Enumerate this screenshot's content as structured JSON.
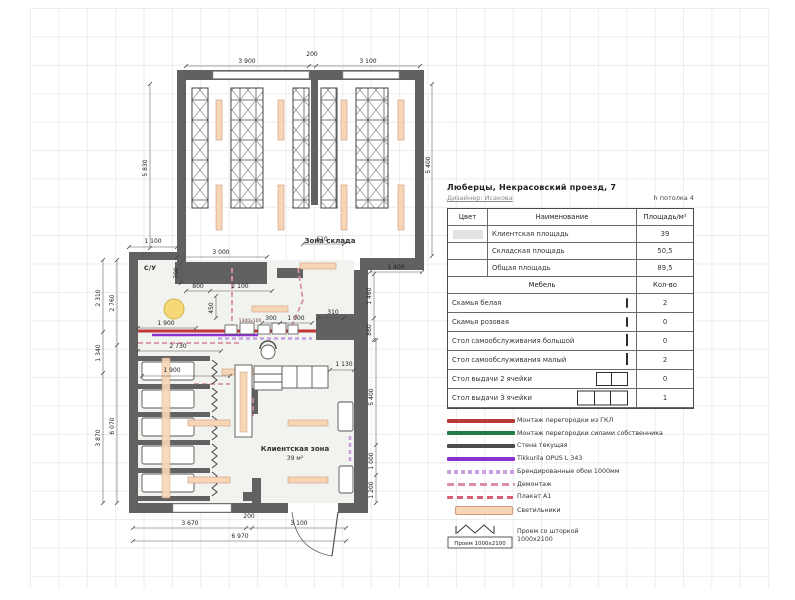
{
  "header": {
    "address": "Люберцы,  Некрасовский проезд, 7",
    "designer": "Дизайнер: Исакова",
    "ceiling": "h потолка 4"
  },
  "area_table": {
    "col_color": "Цвет",
    "col_name": "Наименование",
    "col_area": "Площадь/м²",
    "rows": [
      {
        "name": "Клиентская площадь",
        "area": "39"
      },
      {
        "name": "Складская площадь",
        "area": "50,5"
      },
      {
        "name": "Общая площадь",
        "area": "89,5"
      }
    ]
  },
  "furniture_table": {
    "col_name": "Мебель",
    "col_qty": "Кол-во",
    "rows": [
      {
        "name": "Скамья белая",
        "qty": "2"
      },
      {
        "name": "Скамья розовая",
        "qty": "0"
      },
      {
        "name": "Стол самообслуживания большой",
        "qty": "0"
      },
      {
        "name": "Стол самообслуживания малый",
        "qty": "2"
      },
      {
        "name": "Стол выдачи 2 ячейки",
        "qty": "0"
      },
      {
        "name": "Стол выдачи 3 ячейки",
        "qty": "1"
      }
    ]
  },
  "legend": {
    "gkl": "Монтаж перегородки из ГКЛ",
    "owner": "Монтаж перегородки силами собственника",
    "wall": "Стена текущая",
    "paint": "Tikkurila OPUS L 343",
    "wallpaper": "Брендированные обои 1000мм",
    "demontage": "Демонтаж",
    "poster": "Плакат А1",
    "lamps": "Светильники",
    "curtain": "Проем со шторкой 1000х2100",
    "curtain_box": "Проем 1000х2100"
  },
  "plan": {
    "labels": {
      "storage": "Зона склада",
      "client": "Клиентская зона",
      "client_area": "39 м²",
      "wc": "С/У",
      "shelf": "1300х100"
    },
    "dims": {
      "top_a": "3 900",
      "top_b": "200",
      "top_c": "3 100",
      "stor_left": "5 830",
      "stor_right": "5 400",
      "notch": "1 100",
      "w3000": "3 000",
      "d700": "700",
      "d800": "800",
      "d2100": "2 100",
      "d450": "450",
      "d610": "610",
      "d1400": "1 400",
      "d1460": "1 460",
      "d860": "860",
      "d1900a": "1 900",
      "d2730": "2 730",
      "d300": "300",
      "d1000": "1 000",
      "d310": "310",
      "d1130": "1 130",
      "d1900b": "1 900",
      "l2310": "2 310",
      "l1340": "1 340",
      "l3870": "3 870",
      "l2760": "2 760",
      "l6070": "6 070",
      "r5400": "5 400",
      "r1000": "1 000",
      "r1200": "1 200",
      "b3670": "3 670",
      "b200": "200",
      "b3100": "3 100",
      "b6970": "6 970"
    }
  },
  "colors": {
    "wall": "#616161",
    "partition_gkl": "#c03535",
    "partition_owner": "#257a4c",
    "paint": "#8c2fd0",
    "wallpaper": "#c9a0e6",
    "demontage": "#dc8fa2",
    "poster": "#d95f72",
    "lamp": "#f7d6b8",
    "pouf": "#f6d878"
  }
}
